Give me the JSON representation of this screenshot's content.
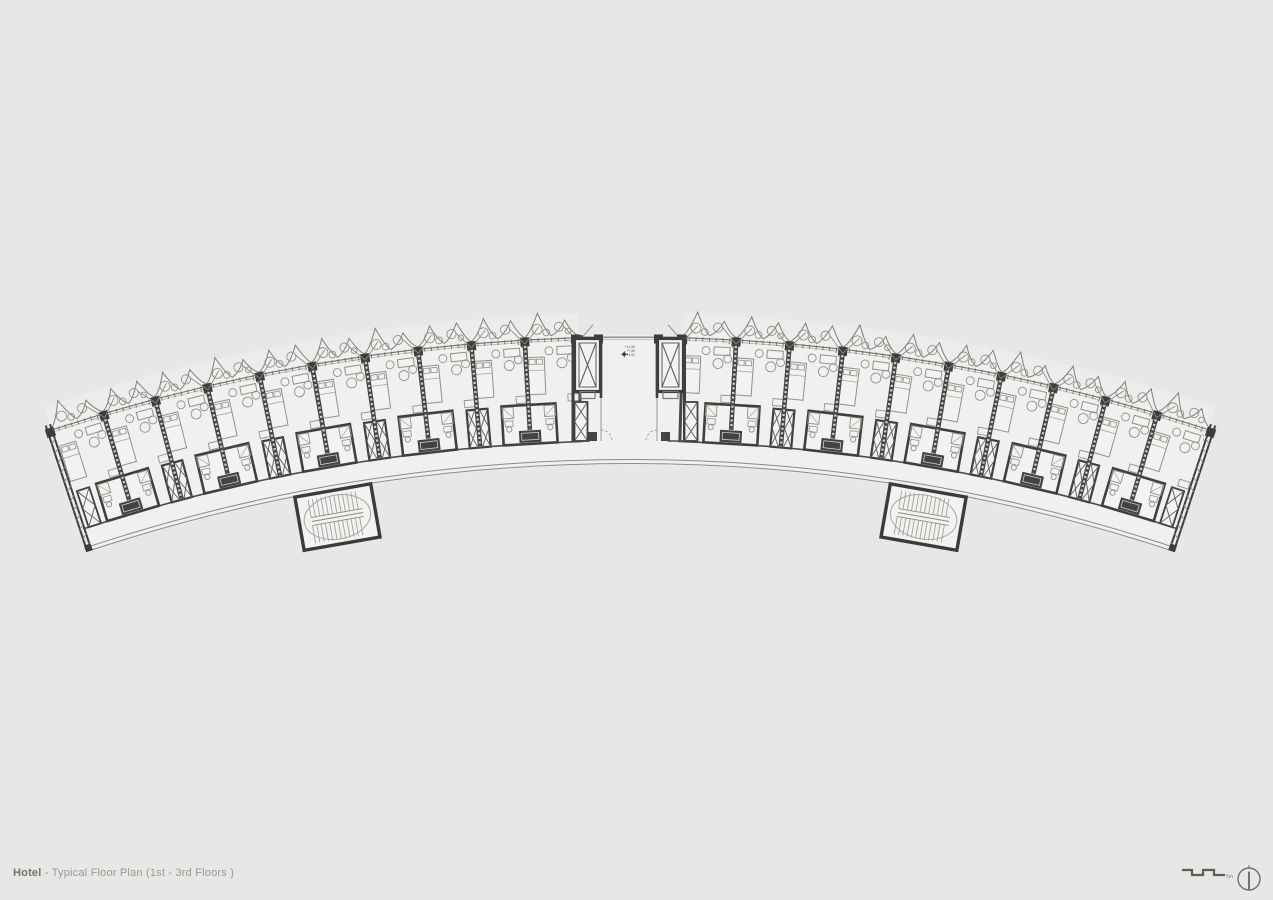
{
  "title": {
    "bold": "Hotel",
    "rest": " - Typical Floor Plan (1st - 3rd Floors )"
  },
  "scale_bar": {
    "label": "5m"
  },
  "north_symbol": "north-arrow",
  "level_marker": {
    "lines": [
      "+11.00",
      "+7.50",
      "+4.00"
    ]
  },
  "plan": {
    "drawing_type": "typical hotel floor plan, curved wing",
    "floors_label": "1st - 3rd Floors",
    "rooms_per_wing": 10,
    "wings": 2,
    "stair_cores": 2,
    "elevator_shafts": 2,
    "colors": {
      "background": "#e8e7e5",
      "slab": "#f1f0ee",
      "wall_dark": "#3f3f3d",
      "line_medium": "#8a8a86",
      "line_light": "#b3b3af",
      "title_gray": "#9a9792"
    }
  }
}
